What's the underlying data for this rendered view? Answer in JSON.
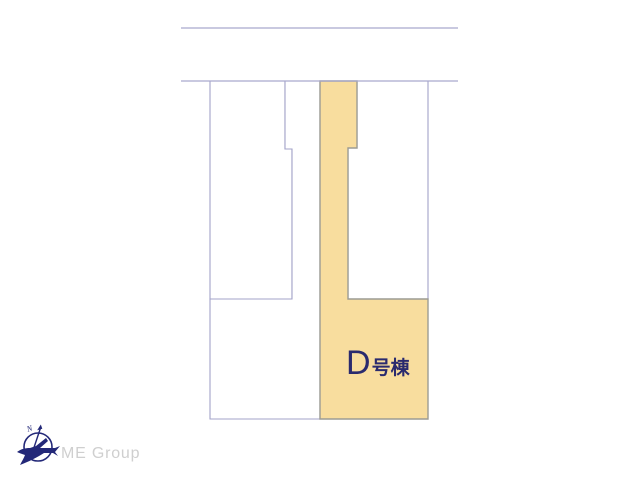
{
  "site_plan": {
    "highlighted_lot": {
      "label_letter": "D",
      "label_suffix": "号棟"
    },
    "colors": {
      "highlight_fill": "#F8DD9E",
      "highlight_border": "#9C9C94",
      "lot_fill": "#FFFFFF",
      "lot_border": "#A3A3C8",
      "road_line": "#A9A9CE",
      "label_text": "#2A2A6E"
    }
  },
  "branding": {
    "company_name": "ME Group",
    "compass_north_label": "N",
    "colors": {
      "logo": "#232878",
      "company_text": "#CFCFCF"
    }
  }
}
